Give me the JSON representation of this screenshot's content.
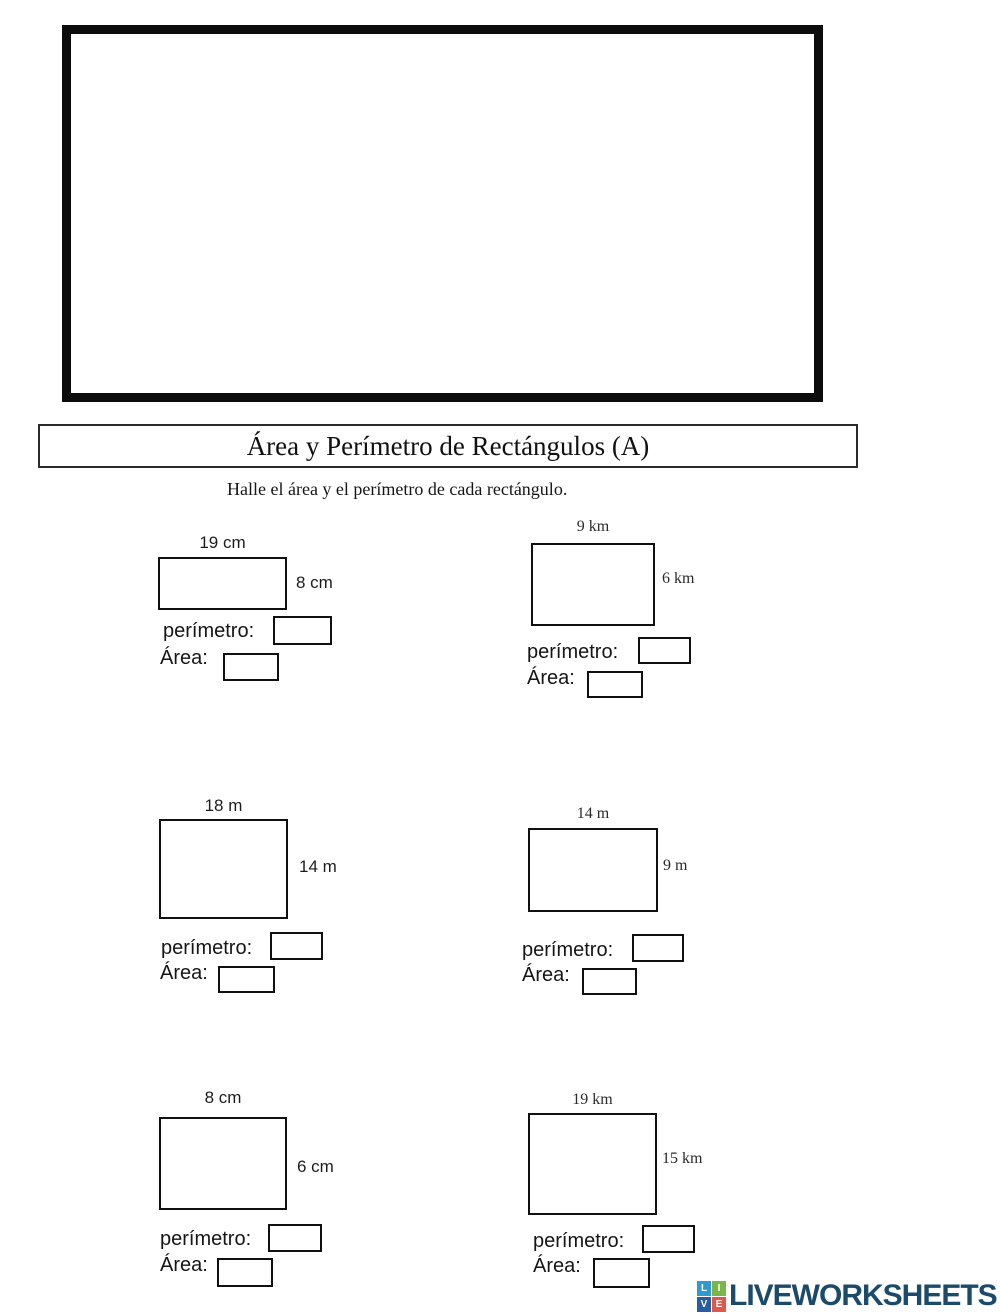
{
  "worksheet": {
    "title": "Área y Perímetro de Rectángulos (A)",
    "instruction": "Halle el área y el perímetro de cada rectángulo.",
    "perimeter_label": "perímetro:",
    "area_label": "Área:"
  },
  "problems": [
    {
      "width_label": "19 cm",
      "height_label": "8 cm"
    },
    {
      "width_label": "9 km",
      "height_label": "6 km"
    },
    {
      "width_label": "18 m",
      "height_label": "14 m"
    },
    {
      "width_label": "14 m",
      "height_label": "9 m"
    },
    {
      "width_label": "8 cm",
      "height_label": "6 cm"
    },
    {
      "width_label": "19 km",
      "height_label": "15 km"
    }
  ],
  "answers": {
    "perimeter_value": "",
    "area_value": ""
  },
  "logo": {
    "text": "LIVEWORKSHEETS",
    "text_color": "#1b4a6b",
    "tiles": [
      {
        "letter": "L",
        "color": "#2f9ad0"
      },
      {
        "letter": "I",
        "color": "#7ab648"
      },
      {
        "letter": "V",
        "color": "#2a5d9f"
      },
      {
        "letter": "E",
        "color": "#e2574c"
      }
    ]
  }
}
